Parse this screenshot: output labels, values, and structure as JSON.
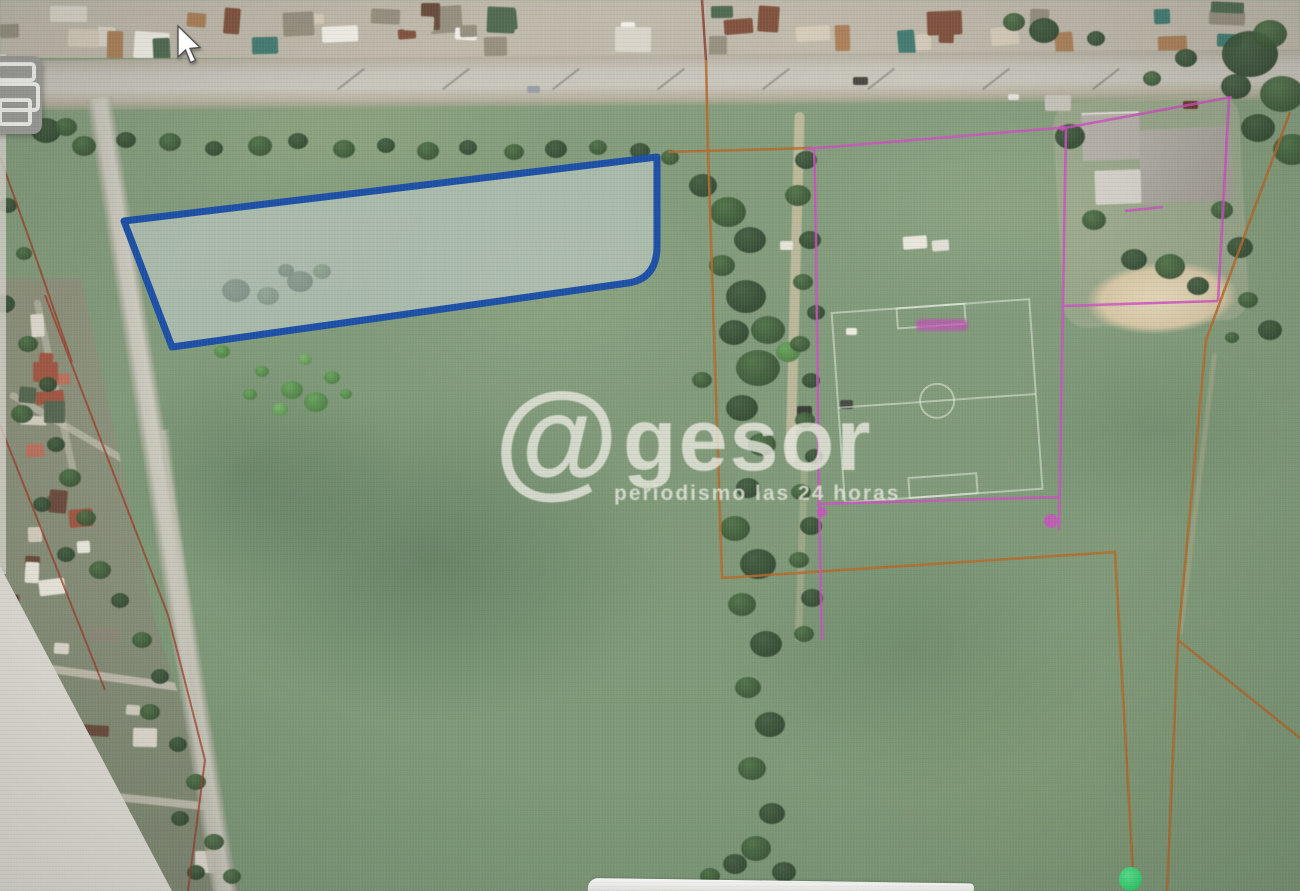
{
  "watermark": {
    "at_symbol": "@",
    "brand": "gesor",
    "tagline": "periodismo las 24 horas"
  },
  "map": {
    "kind": "aerial imagery with cadastral overlay",
    "selected_parcel_outline_color": "#1c4fa5",
    "selected_parcel_fill_color": "rgba(208,215,218,0.5)",
    "boundary_color_orange": "#b46a2c",
    "boundary_color_magenta": "#cd4fc3",
    "boundary_color_red": "#9c3a26",
    "marker_dot_color": "#35d873",
    "parcel_label_color": "#c24fb5"
  }
}
